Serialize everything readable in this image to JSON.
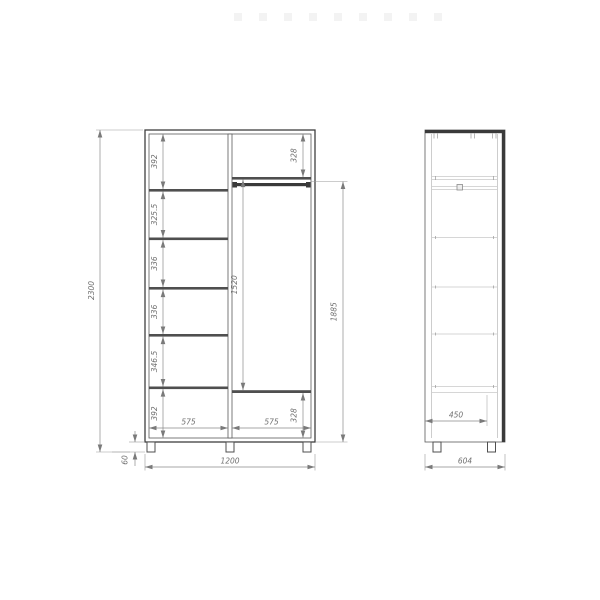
{
  "drawing": {
    "kind": "wardrobe-dimension-drawing",
    "views": {
      "front": "front-section-view",
      "side": "side-view"
    }
  },
  "colors": {
    "outline": "#3f3f3f",
    "panel": "#4f4f4f",
    "dimension_line": "#8a8a8a",
    "label": "#707070",
    "faint_line": "#c8c8c8",
    "watermark": "#f3f3f3"
  },
  "front_view": {
    "overall_height_mm": "2300",
    "overall_width_mm": "1200",
    "plinth_height_mm": "60",
    "left_column_sections_mm": [
      "392",
      "325.5",
      "336",
      "336",
      "346.5",
      "392"
    ],
    "right_top_section_mm": "328",
    "hanging_space_mm": "1520",
    "rod_height_mm": "1885",
    "right_bottom_section_mm": "328",
    "left_column_width_mm": "575",
    "right_column_width_mm": "575"
  },
  "side_view": {
    "inner_depth_mm": "450",
    "overall_depth_mm": "604"
  }
}
